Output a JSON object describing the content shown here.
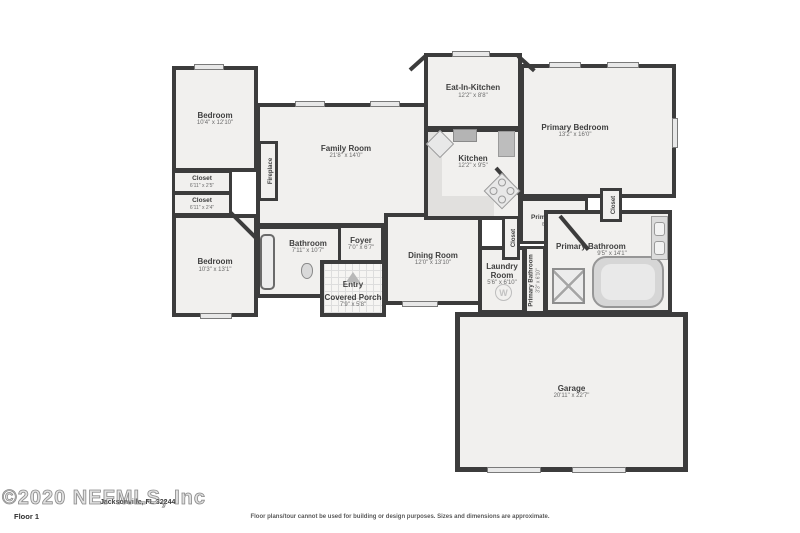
{
  "colors": {
    "wall": "#3c3c3c",
    "room_fill": "#f1f0ee",
    "fixture_gray": "#d8d8d8",
    "label_text": "#3f3f3f"
  },
  "plan": {
    "rooms": {
      "bedroom1": {
        "name": "Bedroom",
        "dims": "10'4\" x 12'10\""
      },
      "closet_a": {
        "name": "Closet",
        "dims": "6'11\" x 2'5\""
      },
      "closet_b": {
        "name": "Closet",
        "dims": "6'11\" x 2'4\""
      },
      "bedroom2": {
        "name": "Bedroom",
        "dims": "10'3\" x 13'1\""
      },
      "family_room": {
        "name": "Family Room",
        "dims": "21'8\" x 14'0\""
      },
      "fireplace": {
        "name": "Fireplace"
      },
      "bathroom": {
        "name": "Bathroom",
        "dims": "7'11\" x 10'7\""
      },
      "foyer": {
        "name": "Foyer",
        "dims": "7'0\" x 6'7\""
      },
      "entry": {
        "name": "Entry"
      },
      "covered_porch": {
        "name": "Covered Porch",
        "dims": "7'9\" x 5'8\""
      },
      "dining_room": {
        "name": "Dining Room",
        "dims": "12'0\" x 13'10\""
      },
      "eat_in_kitchen": {
        "name": "Eat-In-Kitchen",
        "dims": "12'2\" x 8'8\""
      },
      "kitchen": {
        "name": "Kitchen",
        "dims": "12'2\" x 9'5\""
      },
      "primary_bedroom": {
        "name": "Primary Bedroom",
        "dims": "13'2\" x 16'0\""
      },
      "primary_closet": {
        "name": "Primary Closet",
        "dims": "6'8\" x 6'11\""
      },
      "hall_closet": {
        "name": "Closet"
      },
      "laundry_room": {
        "name": "Laundry Room",
        "dims": "5'6\" x 6'10\""
      },
      "primary_bathroom_small": {
        "name": "Primary Bathroom",
        "dims": "3'3\" x 6'10\""
      },
      "primary_bathroom": {
        "name": "Primary Bathroom",
        "dims": "9'5\" x 14'1\""
      },
      "right_closet": {
        "name": "Closet"
      },
      "garage": {
        "name": "Garage",
        "dims": "20'11\" x 22'7\""
      }
    },
    "washer_label": "W"
  },
  "footer": {
    "watermark": "©2020 NEFMLS, Inc",
    "address": "Jacksonville, FL 32244",
    "floor_label": "Floor 1",
    "disclaimer": "Floor plans/tour cannot be used for building or design purposes. Sizes and dimensions are approximate."
  }
}
